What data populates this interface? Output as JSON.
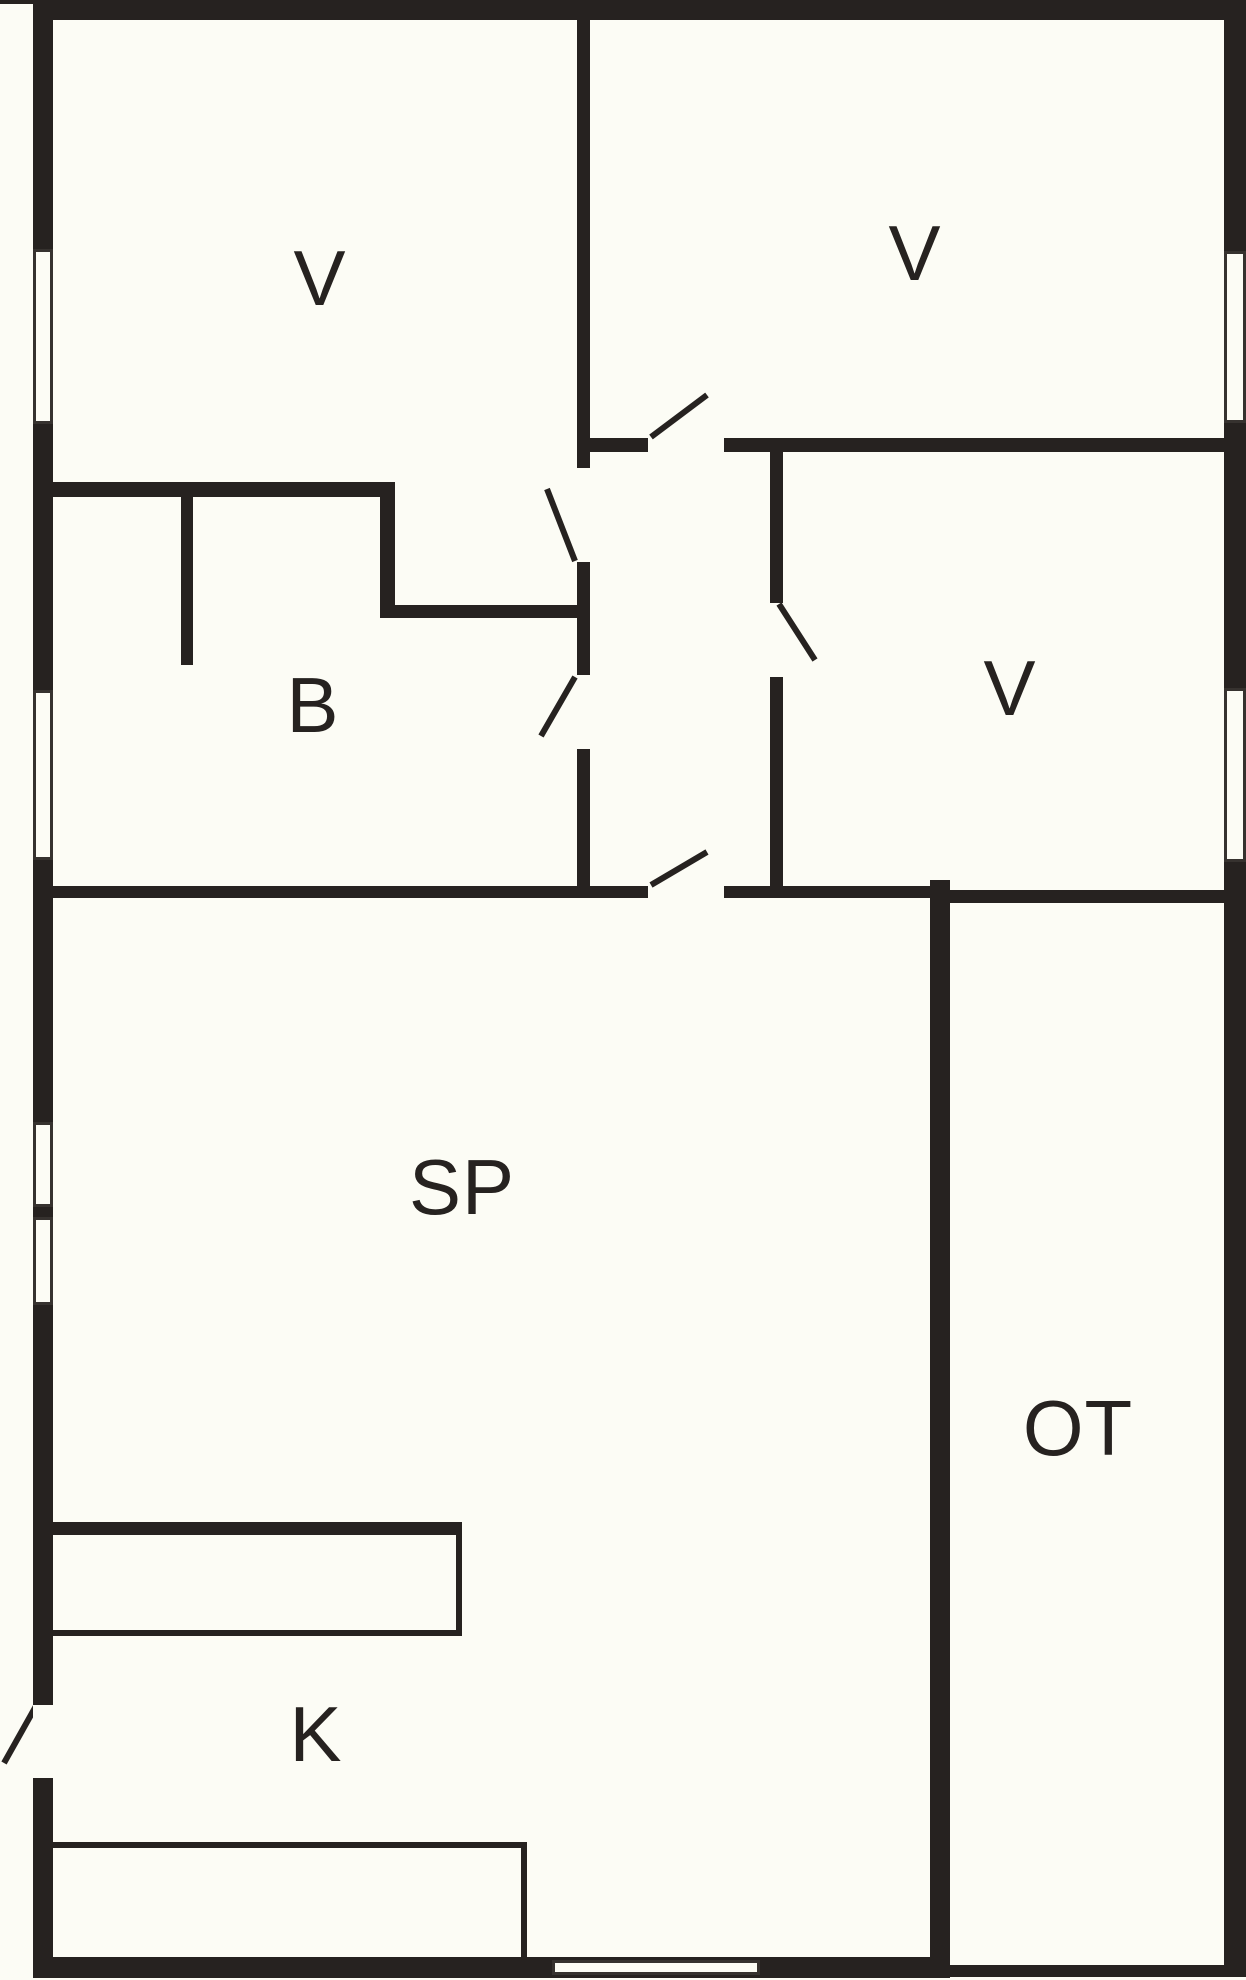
{
  "canvas": {
    "width": 1246,
    "height": 1980,
    "background": "#FCFCF5",
    "ink": "#262220",
    "label_font_size": 78
  },
  "rooms": [
    {
      "id": "bedroom-top-left",
      "label": "V",
      "x": 320,
      "y": 278
    },
    {
      "id": "bedroom-top-right",
      "label": "V",
      "x": 915,
      "y": 253
    },
    {
      "id": "bathroom",
      "label": "B",
      "x": 313,
      "y": 705
    },
    {
      "id": "bedroom-mid-right",
      "label": "V",
      "x": 1010,
      "y": 688
    },
    {
      "id": "living-room",
      "label": "SP",
      "x": 462,
      "y": 1187
    },
    {
      "id": "terrace",
      "label": "OT",
      "x": 1078,
      "y": 1428
    },
    {
      "id": "kitchen",
      "label": "K",
      "x": 316,
      "y": 1734
    }
  ],
  "walls": [
    {
      "name": "exterior-top-left-tick",
      "x": 0,
      "y": 0,
      "w": 33,
      "h": 4
    },
    {
      "name": "exterior-top",
      "x": 33,
      "y": 0,
      "w": 1213,
      "h": 20
    },
    {
      "name": "exterior-left",
      "x": 33,
      "y": 0,
      "w": 20,
      "h": 1978
    },
    {
      "name": "exterior-right",
      "x": 1224,
      "y": 0,
      "w": 22,
      "h": 1977
    },
    {
      "name": "exterior-bottom-main",
      "x": 33,
      "y": 1957,
      "w": 917,
      "h": 21
    },
    {
      "name": "exterior-bottom-terrace",
      "x": 950,
      "y": 1965,
      "w": 296,
      "h": 12
    },
    {
      "name": "divider-vertical-top",
      "x": 577,
      "y": 20,
      "w": 13,
      "h": 448
    },
    {
      "name": "divider-vertical-mid",
      "x": 577,
      "y": 562,
      "w": 13,
      "h": 113
    },
    {
      "name": "divider-vertical-low",
      "x": 577,
      "y": 749,
      "w": 13,
      "h": 137
    },
    {
      "name": "bedrooms-divider-left",
      "x": 590,
      "y": 438,
      "w": 58,
      "h": 14
    },
    {
      "name": "bedrooms-divider-right",
      "x": 724,
      "y": 438,
      "w": 500,
      "h": 14
    },
    {
      "name": "hall-right-wall-upper",
      "x": 770,
      "y": 452,
      "w": 13,
      "h": 151
    },
    {
      "name": "hall-right-wall-lower",
      "x": 770,
      "y": 677,
      "w": 13,
      "h": 209
    },
    {
      "name": "bathroom-top-wall",
      "x": 53,
      "y": 482,
      "w": 342,
      "h": 15
    },
    {
      "name": "bathroom-corner-vertical",
      "x": 380,
      "y": 497,
      "w": 15,
      "h": 121
    },
    {
      "name": "alcove-bottom-wall",
      "x": 395,
      "y": 605,
      "w": 193,
      "h": 13
    },
    {
      "name": "bathroom-stub",
      "x": 181,
      "y": 497,
      "w": 12,
      "h": 168
    },
    {
      "name": "living-top-wall-left",
      "x": 53,
      "y": 886,
      "w": 595,
      "h": 12
    },
    {
      "name": "living-top-wall-right",
      "x": 724,
      "y": 886,
      "w": 206,
      "h": 12
    },
    {
      "name": "terrace-left-wall",
      "x": 930,
      "y": 880,
      "w": 20,
      "h": 1098
    },
    {
      "name": "terrace-top-wall",
      "x": 950,
      "y": 890,
      "w": 274,
      "h": 13
    },
    {
      "name": "kitchen-counter-top-back",
      "x": 53,
      "y": 1522,
      "w": 409,
      "h": 13
    },
    {
      "name": "kitchen-counter-top-right",
      "x": 456,
      "y": 1535,
      "w": 6,
      "h": 100
    },
    {
      "name": "kitchen-counter-top-front",
      "x": 53,
      "y": 1630,
      "w": 409,
      "h": 6
    },
    {
      "name": "kitchen-counter-bottom-back",
      "x": 53,
      "y": 1842,
      "w": 474,
      "h": 6
    },
    {
      "name": "kitchen-counter-bottom-right",
      "x": 521,
      "y": 1848,
      "w": 6,
      "h": 109
    }
  ],
  "windows": [
    {
      "name": "window-left-bedroom-1",
      "x": 33,
      "y": 249,
      "w": 20,
      "h": 175
    },
    {
      "name": "window-left-bathroom",
      "x": 33,
      "y": 690,
      "w": 20,
      "h": 170
    },
    {
      "name": "window-left-living-1",
      "x": 33,
      "y": 1122,
      "w": 20,
      "h": 85
    },
    {
      "name": "window-left-living-2",
      "x": 33,
      "y": 1217,
      "w": 20,
      "h": 88
    },
    {
      "name": "window-right-bedroom-2",
      "x": 1224,
      "y": 251,
      "w": 22,
      "h": 172
    },
    {
      "name": "window-right-bedroom-3",
      "x": 1224,
      "y": 688,
      "w": 22,
      "h": 174
    },
    {
      "name": "window-bottom-living",
      "x": 552,
      "y": 1960,
      "w": 208,
      "h": 15
    }
  ],
  "door_openings": [
    {
      "name": "entry-door-opening",
      "x": 33,
      "y": 1705,
      "w": 20,
      "h": 73
    }
  ],
  "door_leaves": [
    {
      "name": "entry-door-leaf",
      "x1": 36,
      "y1": 1706,
      "x2": 4,
      "y2": 1763
    },
    {
      "name": "bedroom-1-door-leaf",
      "x1": 575,
      "y1": 561,
      "x2": 547,
      "y2": 489
    },
    {
      "name": "bathroom-door-leaf",
      "x1": 575,
      "y1": 677,
      "x2": 541,
      "y2": 736
    },
    {
      "name": "bedroom-2-door-leaf",
      "x1": 651,
      "y1": 437,
      "x2": 707,
      "y2": 395
    },
    {
      "name": "bedroom-3-door-leaf",
      "x1": 779,
      "y1": 604,
      "x2": 815,
      "y2": 660
    },
    {
      "name": "living-room-door-leaf",
      "x1": 651,
      "y1": 885,
      "x2": 707,
      "y2": 852
    }
  ]
}
